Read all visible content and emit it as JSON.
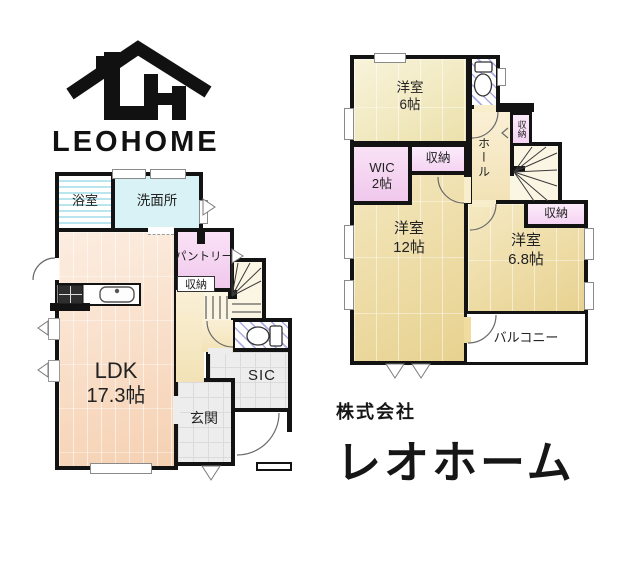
{
  "logo": {
    "wordmark": "LEOHOME"
  },
  "company": {
    "prefix": "株式会社",
    "name": "レオホーム"
  },
  "floor1": {
    "bath": "浴室",
    "washroom": "洗面所",
    "pantry": "パントリー",
    "pantry_storage": "収納",
    "ldk": {
      "name": "LDK",
      "size": "17.3帖"
    },
    "entrance": "玄関",
    "shoe_closet": "SIC"
  },
  "floor2": {
    "bedroom_6": {
      "name": "洋室",
      "size": "6帖"
    },
    "wic": {
      "name": "WIC",
      "size": "2帖"
    },
    "closet_by_wic": "収納",
    "hall": "ホール",
    "hall_storage": "収納",
    "bedroom_12": {
      "name": "洋室",
      "size": "12帖"
    },
    "bedroom_68": {
      "name": "洋室",
      "size": "6.8帖"
    },
    "closet_68": "収納",
    "balcony": "バルコニー"
  },
  "colors": {
    "wall": "#131313",
    "ldk_floor": "#f9dcc3",
    "bedroom_floor": "#efdc9e",
    "bedroom6_floor": "#f3ebbe",
    "washroom": "#d8f2f5",
    "pantry": "#f5d5f1",
    "wic": "#f5cff2",
    "tile": "#ededed",
    "hall": "#f6ecc6",
    "hatch_blue": "#7676d6"
  }
}
